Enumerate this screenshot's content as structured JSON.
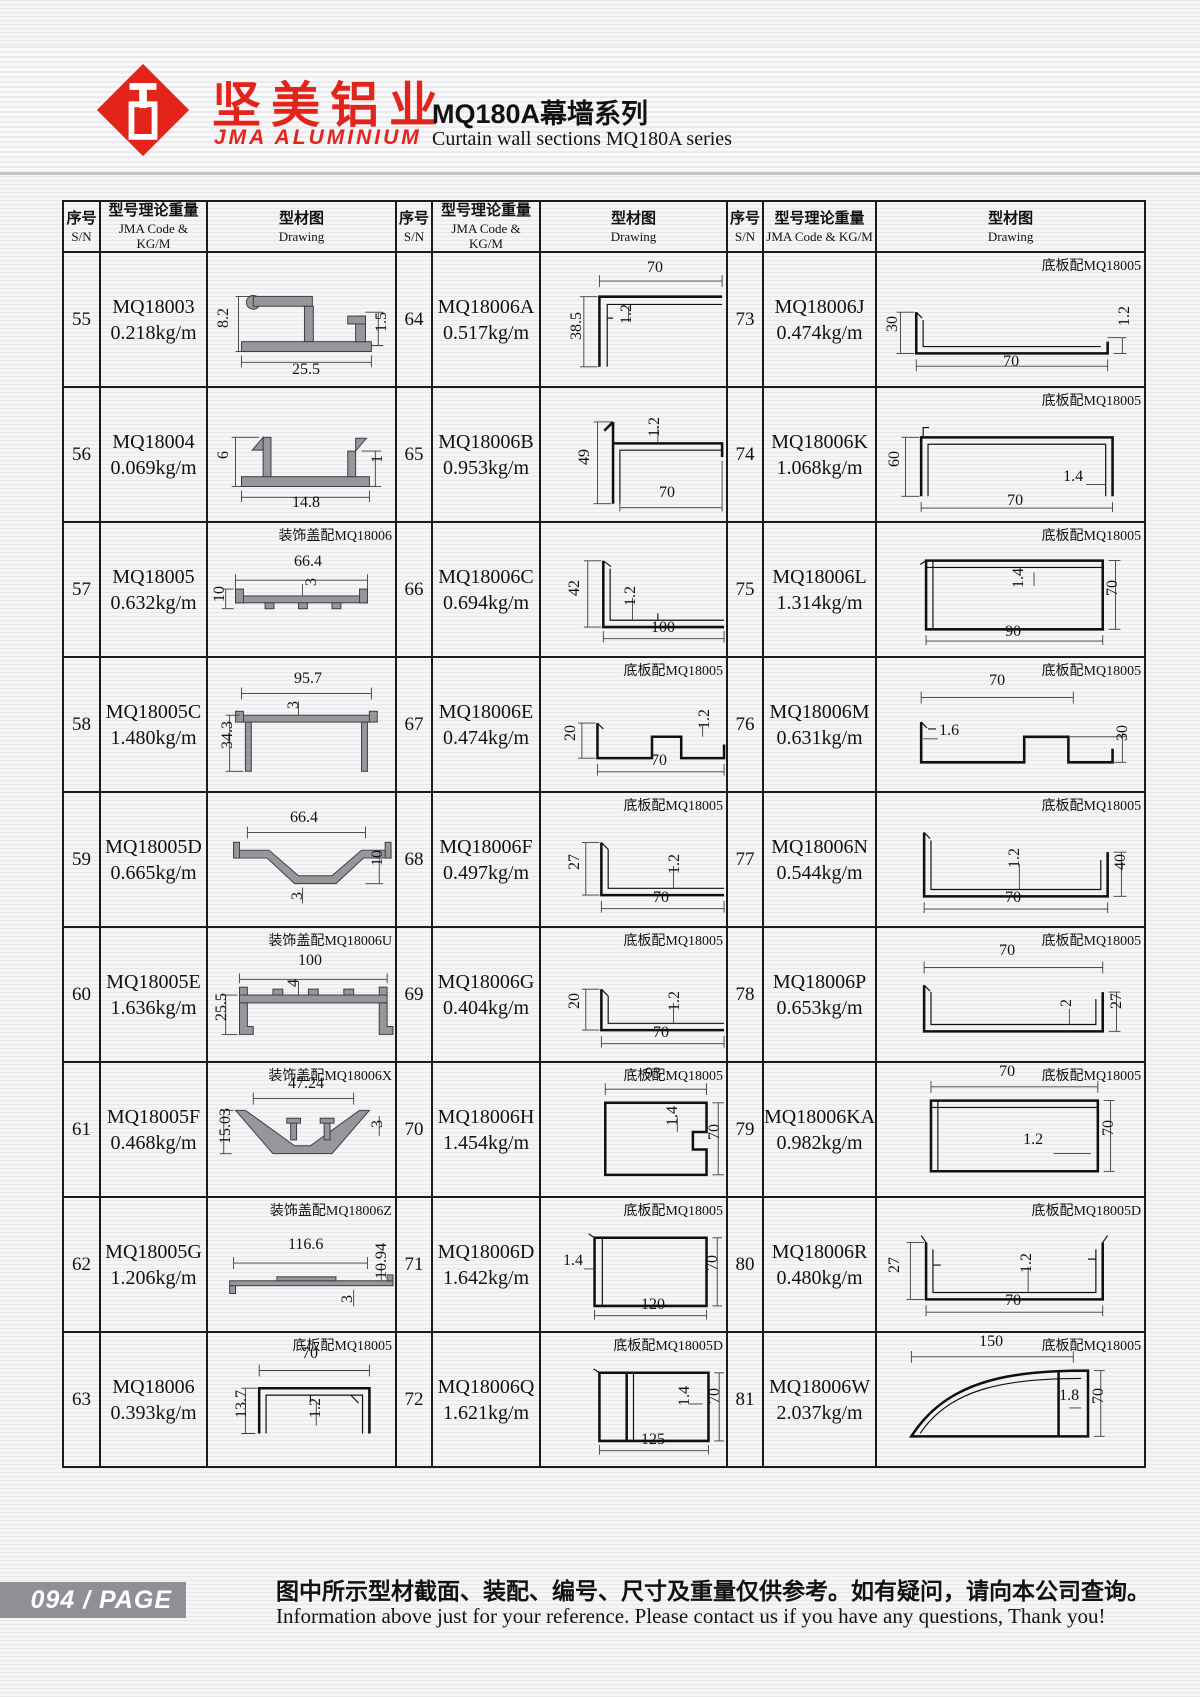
{
  "header": {
    "logo_cn": "坚美铝业",
    "logo_en": "JMA ALUMINIUM",
    "title_cn": "MQ180A幕墙系列",
    "title_en": "Curtain wall sections MQ180A series"
  },
  "table_headers": {
    "sn_cn": "序号",
    "sn_en": "S/N",
    "code_cn": "型号理论重量",
    "code_en": "JMA Code & KG/M",
    "draw_cn": "型材图",
    "draw_en": "Drawing"
  },
  "rows": {
    "r55": {
      "sn": "55",
      "code": "MQ18003",
      "weight": "0.218kg/m",
      "note": "",
      "d1": "8.2",
      "d2": "25.5",
      "d3": "1.5"
    },
    "r56": {
      "sn": "56",
      "code": "MQ18004",
      "weight": "0.069kg/m",
      "note": "",
      "d1": "6",
      "d2": "14.8",
      "d3": "1"
    },
    "r57": {
      "sn": "57",
      "code": "MQ18005",
      "weight": "0.632kg/m",
      "note": "装饰盖配MQ18006",
      "d1": "66.4",
      "d2": "3",
      "d3": "10"
    },
    "r58": {
      "sn": "58",
      "code": "MQ18005C",
      "weight": "1.480kg/m",
      "note": "",
      "d1": "95.7",
      "d2": "34.3",
      "d3": "3"
    },
    "r59": {
      "sn": "59",
      "code": "MQ18005D",
      "weight": "0.665kg/m",
      "note": "",
      "d1": "66.4",
      "d2": "10",
      "d3": "3"
    },
    "r60": {
      "sn": "60",
      "code": "MQ18005E",
      "weight": "1.636kg/m",
      "note": "装饰盖配MQ18006U",
      "d1": "100",
      "d2": "25.5",
      "d3": "4"
    },
    "r61": {
      "sn": "61",
      "code": "MQ18005F",
      "weight": "0.468kg/m",
      "note": "装饰盖配MQ18006X",
      "d1": "47.24",
      "d2": "15.03",
      "d3": "3"
    },
    "r62": {
      "sn": "62",
      "code": "MQ18005G",
      "weight": "1.206kg/m",
      "note": "装饰盖配MQ18006Z",
      "d1": "116.6",
      "d2": "10.94",
      "d3": "3"
    },
    "r63": {
      "sn": "63",
      "code": "MQ18006",
      "weight": "0.393kg/m",
      "note": "底板配MQ18005",
      "d1": "70",
      "d2": "13.7",
      "d3": "1.2"
    },
    "r64": {
      "sn": "64",
      "code": "MQ18006A",
      "weight": "0.517kg/m",
      "note": "",
      "d1": "70",
      "d2": "38.5",
      "d3": "1.2"
    },
    "r65": {
      "sn": "65",
      "code": "MQ18006B",
      "weight": "0.953kg/m",
      "note": "",
      "d1": "49",
      "d2": "1.2",
      "d3": "70"
    },
    "r66": {
      "sn": "66",
      "code": "MQ18006C",
      "weight": "0.694kg/m",
      "note": "",
      "d1": "42",
      "d2": "1.2",
      "d3": "100"
    },
    "r67": {
      "sn": "67",
      "code": "MQ18006E",
      "weight": "0.474kg/m",
      "note": "底板配MQ18005",
      "d1": "20",
      "d2": "1.2",
      "d3": "70"
    },
    "r68": {
      "sn": "68",
      "code": "MQ18006F",
      "weight": "0.497kg/m",
      "note": "底板配MQ18005",
      "d1": "27",
      "d2": "1.2",
      "d3": "70"
    },
    "r69": {
      "sn": "69",
      "code": "MQ18006G",
      "weight": "0.404kg/m",
      "note": "底板配MQ18005",
      "d1": "20",
      "d2": "1.2",
      "d3": "70"
    },
    "r70": {
      "sn": "70",
      "code": "MQ18006H",
      "weight": "1.454kg/m",
      "note": "底板配MQ18005",
      "d1": "93",
      "d2": "1.4",
      "d3": "70"
    },
    "r71": {
      "sn": "71",
      "code": "MQ18006D",
      "weight": "1.642kg/m",
      "note": "底板配MQ18005",
      "d1": "1.4",
      "d2": "120",
      "d3": "70"
    },
    "r72": {
      "sn": "72",
      "code": "MQ18006Q",
      "weight": "1.621kg/m",
      "note": "底板配MQ18005D",
      "d1": "1.4",
      "d2": "125",
      "d3": "70"
    },
    "r73": {
      "sn": "73",
      "code": "MQ18006J",
      "weight": "0.474kg/m",
      "note": "底板配MQ18005",
      "d1": "30",
      "d2": "70",
      "d3": "1.2"
    },
    "r74": {
      "sn": "74",
      "code": "MQ18006K",
      "weight": "1.068kg/m",
      "note": "底板配MQ18005",
      "d1": "60",
      "d2": "1.4",
      "d3": "70"
    },
    "r75": {
      "sn": "75",
      "code": "MQ18006L",
      "weight": "1.314kg/m",
      "note": "底板配MQ18005",
      "d1": "1.4",
      "d2": "90",
      "d3": "70"
    },
    "r76": {
      "sn": "76",
      "code": "MQ18006M",
      "weight": "0.631kg/m",
      "note": "底板配MQ18005",
      "d1": "70",
      "d2": "1.6",
      "d3": "30"
    },
    "r77": {
      "sn": "77",
      "code": "MQ18006N",
      "weight": "0.544kg/m",
      "note": "底板配MQ18005",
      "d1": "1.2",
      "d2": "70",
      "d3": "40"
    },
    "r78": {
      "sn": "78",
      "code": "MQ18006P",
      "weight": "0.653kg/m",
      "note": "底板配MQ18005",
      "d1": "70",
      "d2": "2",
      "d3": "27"
    },
    "r79": {
      "sn": "79",
      "code": "MQ18006KA",
      "weight": "0.982kg/m",
      "note": "底板配MQ18005",
      "d1": "70",
      "d2": "1.2",
      "d3": "70"
    },
    "r80": {
      "sn": "80",
      "code": "MQ18006R",
      "weight": "0.480kg/m",
      "note": "底板配MQ18005D",
      "d1": "27",
      "d2": "1.2",
      "d3": "70"
    },
    "r81": {
      "sn": "81",
      "code": "MQ18006W",
      "weight": "2.037kg/m",
      "note": "底板配MQ18005",
      "d1": "150",
      "d2": "1.8",
      "d3": "70"
    }
  },
  "footer": {
    "page_badge": "094 / PAGE",
    "note_cn": "图中所示型材截面、装配、编号、尺寸及重量仅供参考。如有疑问，请向本公司查询。",
    "note_en": "Information above just for your reference. Please contact us if you have any questions, Thank you!"
  }
}
